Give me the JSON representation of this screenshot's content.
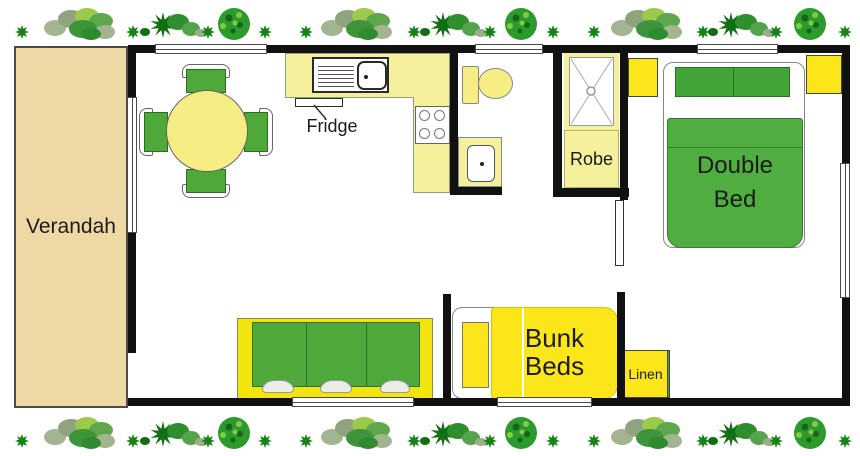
{
  "labels": {
    "verandah": "Verandah",
    "fridge": "Fridge",
    "robe": "Robe",
    "double_bed": "Double\nBed",
    "bunk_beds": "Bunk\nBeds"
  },
  "closets": {
    "items": [
      {
        "label": "Linen",
        "color": "#FBE719",
        "width": 40
      },
      {
        "label": "Robe",
        "color": "#F6F3AC",
        "width": 45
      },
      {
        "label": "Mirror",
        "color": "#4BA534",
        "width": 47
      },
      {
        "label": "Robe",
        "color": "#F6F3AC",
        "width": 42
      },
      {
        "label": "Linen",
        "color": "#FBE719",
        "width": 45
      }
    ]
  },
  "colors": {
    "wall": "#111111",
    "verandah_fill": "#EDD8A6",
    "counter_yellow": "#F5F09C",
    "pale_gold": "#F6EE85",
    "bright_yellow": "#FBE719",
    "couch_yellow": "#F2E40E",
    "furniture_green": "#4FA93A",
    "bed_green": "#4FAE3F",
    "pillow_green": "#43A437",
    "plant_dark": "#168316"
  },
  "plants": {
    "rows": [
      {
        "y": 24
      },
      {
        "y": 433
      }
    ],
    "sequence": [
      {
        "type": "dot",
        "x": 22
      },
      {
        "type": "cluster",
        "x": 85
      },
      {
        "type": "dot",
        "x": 133
      },
      {
        "type": "spiky",
        "x": 172
      },
      {
        "type": "dot",
        "x": 208
      },
      {
        "type": "tree",
        "x": 234
      },
      {
        "type": "dot",
        "x": 265
      },
      {
        "type": "dot",
        "x": 306
      },
      {
        "type": "cluster",
        "x": 362
      },
      {
        "type": "dot",
        "x": 414
      },
      {
        "type": "spiky",
        "x": 452
      },
      {
        "type": "dot",
        "x": 490
      },
      {
        "type": "tree",
        "x": 521
      },
      {
        "type": "dot",
        "x": 553
      },
      {
        "type": "dot",
        "x": 594
      },
      {
        "type": "cluster",
        "x": 652
      },
      {
        "type": "dot",
        "x": 703
      },
      {
        "type": "spiky",
        "x": 740
      },
      {
        "type": "dot",
        "x": 776
      },
      {
        "type": "tree",
        "x": 810
      },
      {
        "type": "dot",
        "x": 845
      }
    ]
  }
}
